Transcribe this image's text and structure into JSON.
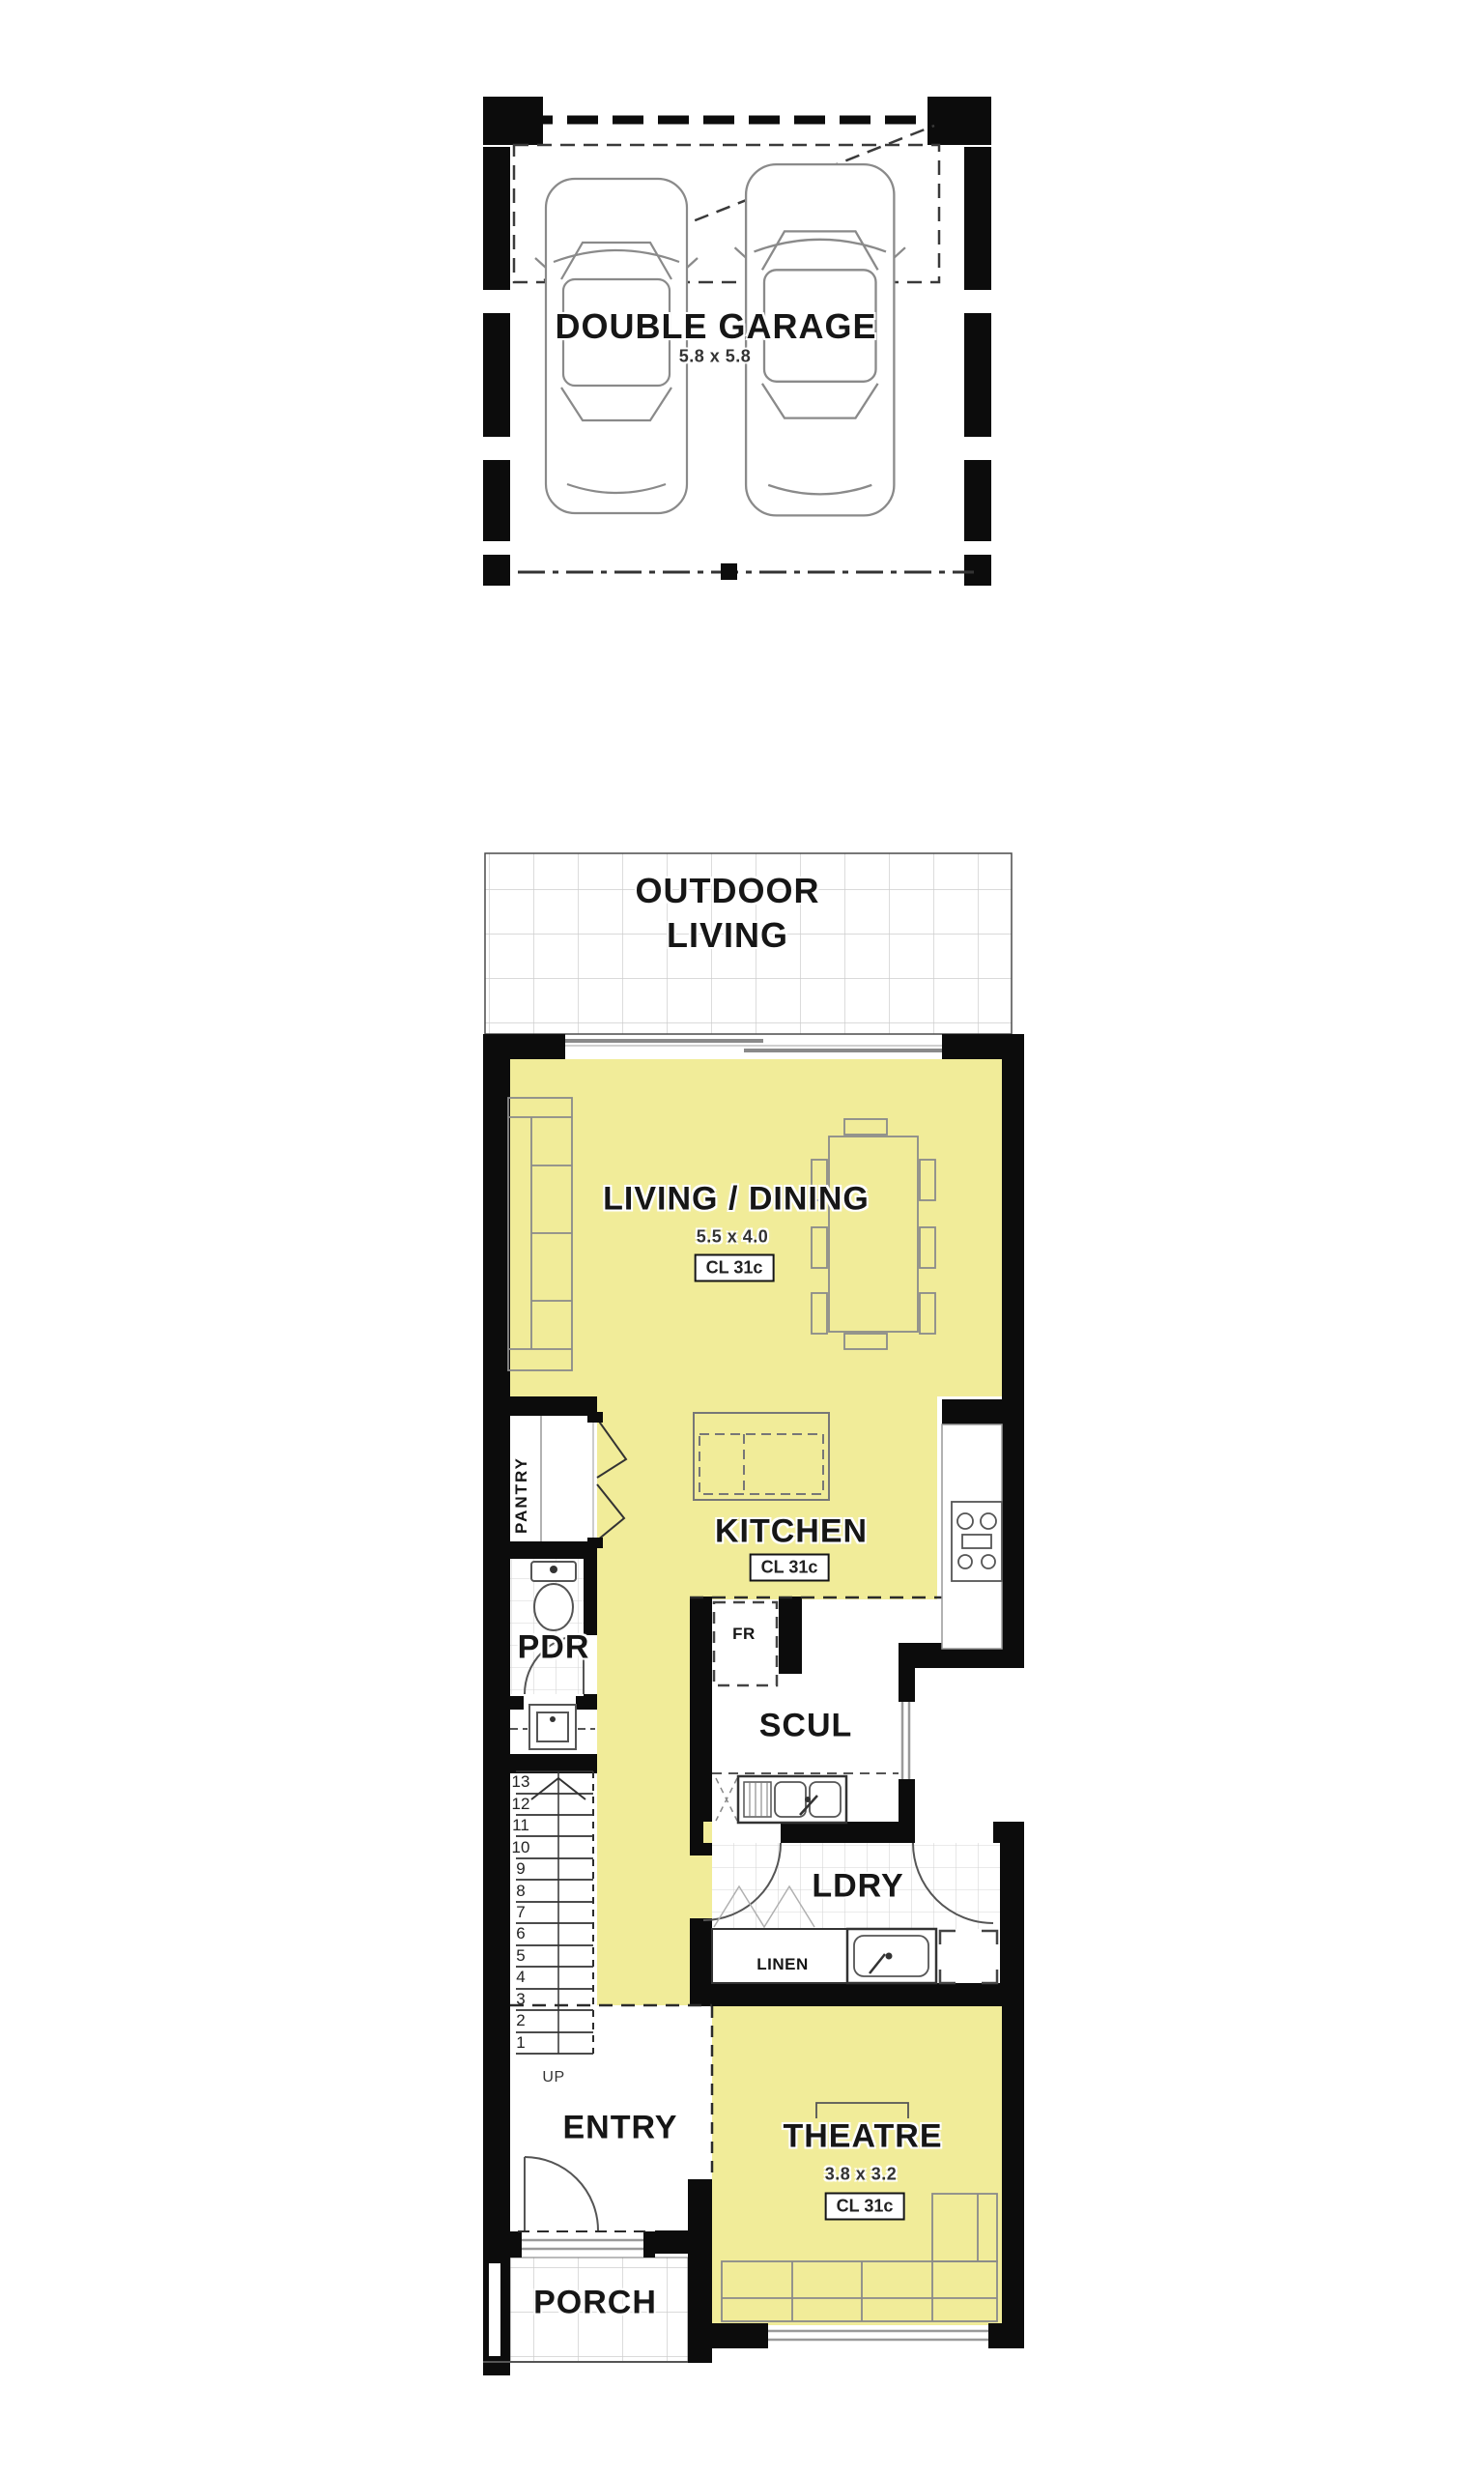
{
  "document": {
    "type": "residential floor plan"
  },
  "colors": {
    "room_highlight": "#F1EC99",
    "wall": "#0C0C0C",
    "tile_line": "#CDCDCD"
  },
  "garage_floor": {
    "title": "DOUBLE GARAGE",
    "dimensions": "5.8 x 5.8"
  },
  "ground_floor": {
    "outdoor_living": {
      "line1": "OUTDOOR",
      "line2": "LIVING"
    },
    "living_dining": {
      "name": "LIVING / DINING",
      "dimensions": "5.5 x 4.0",
      "ceiling": "CL 31c"
    },
    "kitchen": {
      "name": "KITCHEN",
      "ceiling": "CL 31c"
    },
    "pantry": {
      "name": "PANTRY"
    },
    "powder_room": {
      "name": "PDR"
    },
    "fridge": {
      "name": "FR"
    },
    "scullery": {
      "name": "SCUL"
    },
    "laundry": {
      "name": "LDRY"
    },
    "linen": {
      "name": "LINEN"
    },
    "stairs": {
      "treads": [
        "13",
        "12",
        "11",
        "10",
        "9",
        "8",
        "7",
        "6",
        "5",
        "4",
        "3",
        "2",
        "1"
      ],
      "direction_label": "UP"
    },
    "entry": {
      "name": "ENTRY"
    },
    "theatre": {
      "name": "THEATRE",
      "dimensions": "3.8 x 3.2",
      "ceiling": "CL 31c"
    },
    "porch": {
      "name": "PORCH"
    }
  }
}
